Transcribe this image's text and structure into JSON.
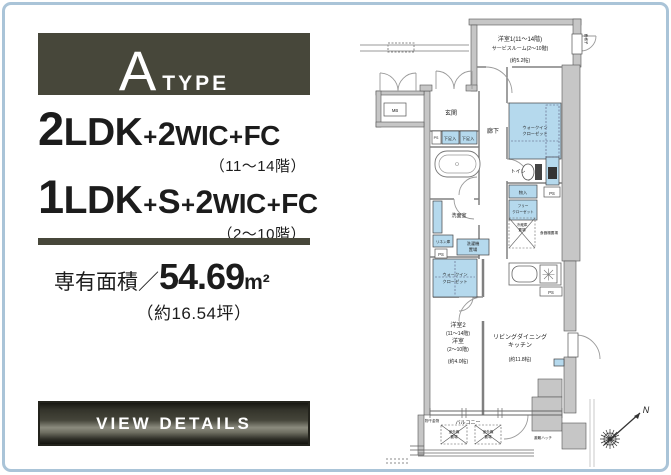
{
  "header": {
    "letter": "A",
    "suffix": "TYPE"
  },
  "plan_types": {
    "line1": {
      "num1": "2",
      "unit1": "LDK",
      "plus1": "+",
      "num2": "2",
      "unit2": "WIC",
      "plus2": "+",
      "unit3": "FC",
      "floors": "（11〜14階）"
    },
    "line2": {
      "num1": "1",
      "unit1": "LDK",
      "plus1": "+",
      "unit2": "S",
      "plus2": "+",
      "num2": "2",
      "unit3": "WIC",
      "plus3": "+",
      "unit4": "FC",
      "floors": "（2〜10階）"
    }
  },
  "area": {
    "label": "専有面積",
    "slash": "／",
    "value": "54.69",
    "unit": "m²",
    "tsubo": "（約16.54坪）"
  },
  "cta": {
    "label": "VIEW DETAILS"
  },
  "colors": {
    "accent_dark": "#47473a",
    "closet_blue": "#b5d9ed",
    "wall_gray": "#c6c6c6",
    "frame_blue": "#aac4d8"
  },
  "floorplan": {
    "room1": {
      "name": "洋室1(11〜14階)",
      "alt": "サービスルーム(2〜10階)",
      "size": "(約5.2帖)"
    },
    "entrance": "玄関",
    "hallway": "廊下",
    "mb": "MB",
    "ps": "PS",
    "shoebox": "下足入",
    "toilet": "トイレ",
    "washroom": "洗面室",
    "linen": "リネン庫",
    "laundry1": "洗濯機",
    "laundry2": "置場",
    "wic_line1": "ウォークイン",
    "wic_line2": "クローゼット",
    "storage": "物入",
    "free_closet1": "フリー",
    "free_closet2": "クローゼット",
    "fridge1": "冷蔵庫",
    "fridge2": "置場",
    "cupboard": "食器棚置場",
    "room2": {
      "name": "洋室2",
      "floors1": "(11〜14階)",
      "alt": "洋室",
      "floors2": "(2〜10階)",
      "size": "(約4.0帖)"
    },
    "ldk": {
      "name1": "リビングダイニング",
      "name2": "キッチン",
      "size": "(約11.8帖)"
    },
    "balcony": "バルコニー",
    "outdoor1": "室外機",
    "outdoor2": "置場",
    "hook": "物干金物",
    "hatch": "避難ハッチ",
    "grille": "面格子",
    "compass": "N"
  }
}
